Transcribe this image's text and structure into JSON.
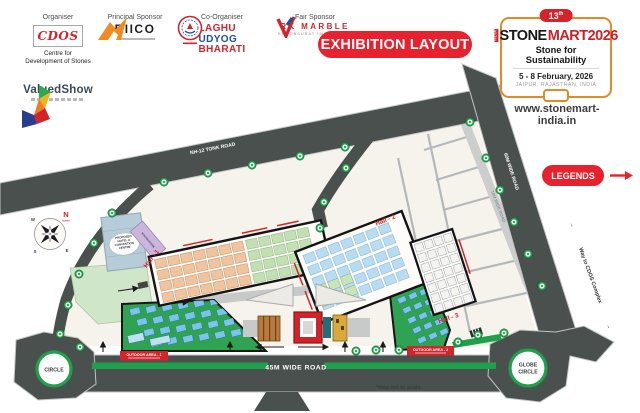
{
  "header": {
    "organiser": {
      "label": "Organiser",
      "logo": "CDOS",
      "line1": "Centre for",
      "line2": "Development of Stones"
    },
    "principal": {
      "label": "Principal Sponsor",
      "logo": "RIICO"
    },
    "coorganiser": {
      "label": "Co-Organiser",
      "word1": "LAGHU",
      "word2": "UDYOG",
      "word3": "BHARATI"
    },
    "fair": {
      "label": "Fair Sponsor",
      "brand": "RK MARBLE",
      "tagline": "KHOOBSURAT IMAANDAARI"
    },
    "valuedshow": {
      "name": "ValuedShow"
    },
    "banner": "EXHIBITION LAYOUT",
    "event": {
      "badge": "13",
      "badge_sup": "th",
      "prefix": "INDIA",
      "brand_black": "STONE",
      "brand_red": "MART2026",
      "tagline": "Stone for Sustainability",
      "dates": "5 - 8 February, 2026",
      "venue": "JAIPUR, RAJASTHAN, INDIA",
      "website": "www.stonemart-india.in"
    }
  },
  "legend": {
    "label": "LEGENDS"
  },
  "map": {
    "roads": {
      "nh12": "NH-12 TONK ROAD",
      "w60": "60M WIDE ROAD",
      "w18": "18M WIDE ROAD",
      "w45": "45M WIDE ROAD"
    },
    "way_cdos": {
      "arrow_pre": "→",
      "label": "Way to CDOS Complex",
      "arrow_post": "→"
    },
    "circle_left": "CIRCLE",
    "globe_line1": "GLOBE",
    "globe_line2": "CIRCLE",
    "halls": {
      "h1": "Hall - 1",
      "h2": "Hall - 2",
      "h3": "Hall - 3"
    },
    "outdoor1": "OUTDOOR AREA - 1",
    "outdoor2": "OUTDOOR AREA - 2",
    "hotel": [
      "PROPOSED",
      "HOTEL &",
      "CONVENTION",
      "CENTRE"
    ],
    "registration": "REGISTRATION",
    "compass": {
      "n": "N",
      "north": "NORTH",
      "w": "W",
      "s": "S",
      "e": "E"
    },
    "note": "*Map not to scale."
  },
  "colors": {
    "accent_red": "#e8212e",
    "road_dark": "#4a504e",
    "tree_green": "#23a14c",
    "stripe_green": "#1fa14c",
    "hall1_booth": "#f0c49e",
    "hall2_booth": "#b8dcf2",
    "outdoor_green": "#2fa351",
    "outdoor_booth": "#7cc3e8"
  }
}
